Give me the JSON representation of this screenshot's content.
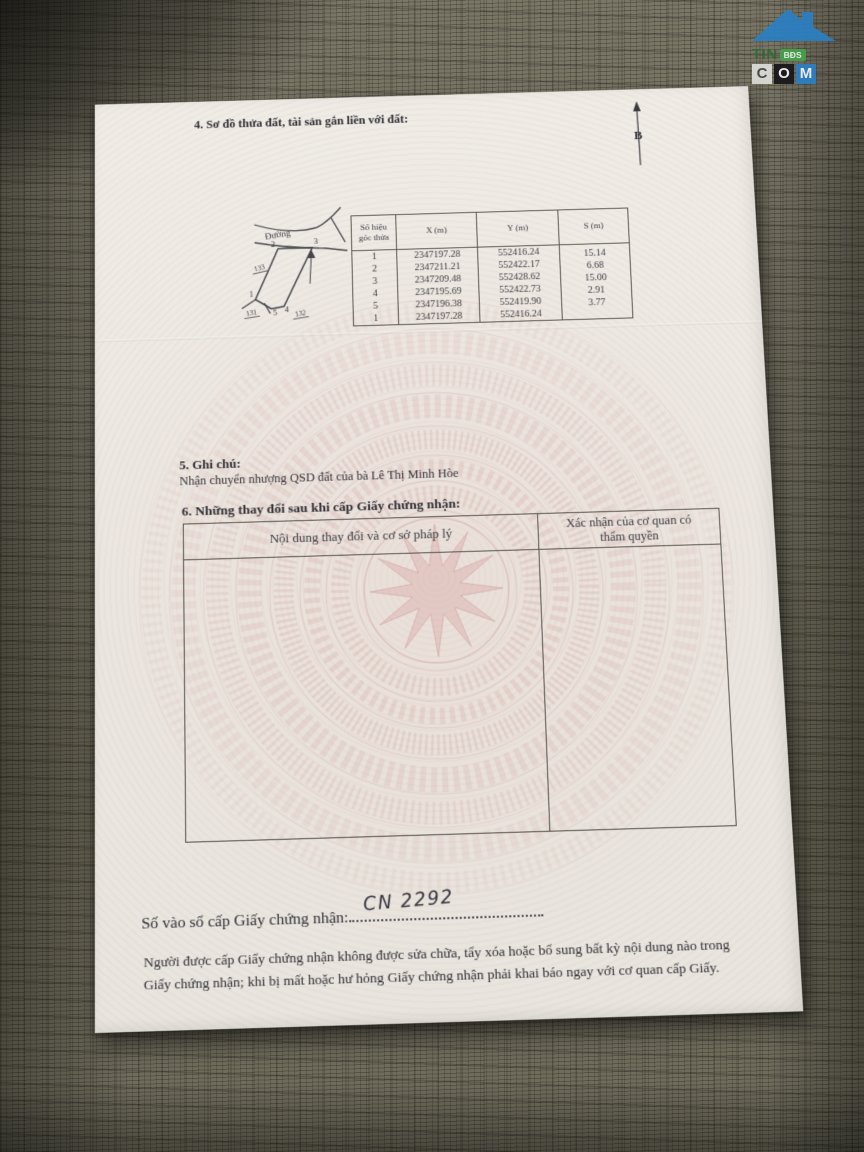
{
  "watermark": {
    "word": "TIN",
    "badge": "BĐS",
    "c": "C",
    "o": "O",
    "m": "M",
    "roof_color": "#2b7fc2"
  },
  "document": {
    "section4": {
      "title": "4. Sơ đồ thửa đất, tài sản gắn liền với đất:",
      "north_label": "B",
      "diagram": {
        "road_label": "Đường",
        "vertices": [
          "1",
          "2",
          "3",
          "4",
          "5"
        ],
        "neighbors": [
          "133",
          "131",
          "132"
        ]
      },
      "table": {
        "header_corner_1": "Số hiệu",
        "header_corner_2": "góc thửa",
        "header_x": "X (m)",
        "header_y": "Y (m)",
        "header_s": "S (m)",
        "rows": [
          {
            "id": "1",
            "x": "2347197.28",
            "y": "552416.24",
            "s": "15.14"
          },
          {
            "id": "2",
            "x": "2347211.21",
            "y": "552422.17",
            "s": "6.68"
          },
          {
            "id": "3",
            "x": "2347209.48",
            "y": "552428.62",
            "s": "15.00"
          },
          {
            "id": "4",
            "x": "2347195.69",
            "y": "552422.73",
            "s": "2.91"
          },
          {
            "id": "5",
            "x": "2347196.38",
            "y": "552419.90",
            "s": "3.77"
          },
          {
            "id": "1",
            "x": "2347197.28",
            "y": "552416.24",
            "s": ""
          }
        ]
      }
    },
    "section5": {
      "title": "5. Ghi chú:",
      "note": "Nhận chuyển nhượng QSD đất của bà Lê Thị Minh Hòe"
    },
    "section6": {
      "title": "6. Những thay đổi sau khi cấp Giấy chứng nhận:",
      "col1_header": "Nội dung thay đổi và cơ sở pháp lý",
      "col2_header": "Xác nhận của cơ quan có thẩm quyền"
    },
    "registry": {
      "label": "Số vào sổ cấp Giấy chứng nhận:",
      "number": "CN 2292"
    },
    "footer": {
      "line1": "Người được cấp Giấy chứng nhận không được sửa chữa, tẩy xóa hoặc bổ sung bất kỳ nội dung nào trong",
      "line2": "Giấy chứng nhận; khi bị mất hoặc hư hỏng Giấy chứng nhận phải khai báo ngay với cơ quan cấp Giấy."
    }
  }
}
